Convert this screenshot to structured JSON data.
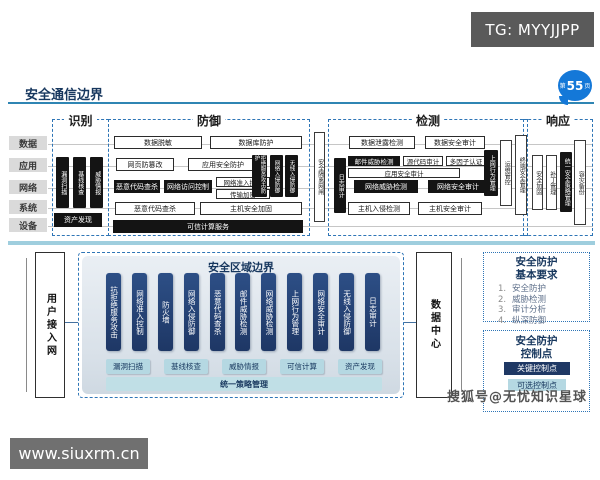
{
  "header": {
    "tg_badge": "TG: MYYJJPP",
    "title": "安全通信边界",
    "page_badge_prefix": "第",
    "page_badge_number": "55",
    "page_badge_suffix": "页"
  },
  "matrix": {
    "row_labels": [
      "数据",
      "应用",
      "网络",
      "系统",
      "设备"
    ],
    "identify": {
      "label": "识别",
      "bars": [
        "漏洞扫描",
        "基线核查",
        "威胁情报"
      ],
      "bottom": "资产发现"
    },
    "defense": {
      "label": "防御",
      "data_row": [
        "数据脱敏",
        "数据库防护"
      ],
      "app_row": [
        "网页防篡改",
        "应用安全防护"
      ],
      "net_black": [
        "恶意代码查杀",
        "网络访问控制"
      ],
      "net_stack": [
        "网络准入控制",
        "传输加密"
      ],
      "bars": [
        "拒绝服务攻击防护",
        "网络入侵防御",
        "无线入侵防御"
      ],
      "sys_row": [
        "恶意代码查杀",
        "主机安全加固"
      ],
      "dev_row": "可信计算服务"
    },
    "gateway": "安全隔离网闸",
    "detect": {
      "label": "检测",
      "log_bar": "日志审计",
      "data_row": [
        "数据泄露检测",
        "数据安全审计"
      ],
      "app_row1": [
        "邮件威胁检测",
        "源代码审计",
        "多因子认证"
      ],
      "app_row2": "应用安全审计",
      "net_row": [
        "网络威胁检测",
        "网络安全审计"
      ],
      "sys_row": [
        "主机入侵检测",
        "主机安全审计"
      ],
      "bars": [
        "上网行为管理",
        "运维管控",
        "终端安全管理"
      ]
    },
    "respond": {
      "label": "响应",
      "bars": [
        "安全加固",
        "补丁管理",
        "统一安全策略管理",
        "容灾备份"
      ]
    }
  },
  "boundary": {
    "left_node": "用户接入网",
    "right_node": "数据中心",
    "title": "安全区域边界",
    "pills": [
      "抗拒绝服务攻击",
      "网络准入控制",
      "防火墙",
      "网络入侵防御",
      "恶意代码查杀",
      "邮件威胁检测",
      "网络威胁检测",
      "上网行为管理",
      "网络安全审计",
      "无线入侵防御",
      "日志审计"
    ],
    "light_pills": [
      "漏洞扫描",
      "基线核查",
      "威胁情报",
      "可信计算",
      "资产发现"
    ],
    "bottom_bar": "统一策略管理"
  },
  "sidebar": {
    "requirements": {
      "title1": "安全防护",
      "title2": "基本要求",
      "nums": [
        "1.",
        "2.",
        "3.",
        "4."
      ],
      "items": [
        "安全防护",
        "威胁检测",
        "审计分析",
        "纵深防御"
      ]
    },
    "control_points": {
      "title1": "安全防护",
      "title2": "控制点",
      "key_btn": "关键控制点",
      "opt_btn": "可选控制点"
    }
  },
  "watermarks": {
    "sohu": "搜狐号@无忧知识星球",
    "site": "www.siuxrm.cn"
  },
  "colors": {
    "navy": "#1f3864",
    "dashed_blue": "#2e75b6",
    "black_box": "#141414",
    "light_pill": "#b5d8e2",
    "badge_blue": "#1478d8",
    "tg_gray": "#5a5a5a"
  }
}
